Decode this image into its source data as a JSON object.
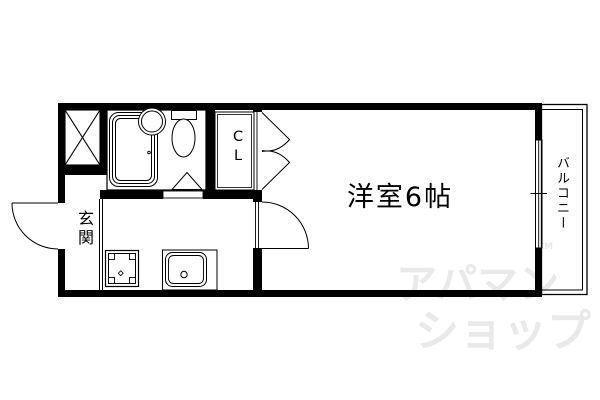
{
  "colors": {
    "line": "#000000",
    "background": "#ffffff",
    "watermark": "#e9e9e9"
  },
  "floor_plan": {
    "western_room": {
      "label": "洋室6帖"
    },
    "entrance": {
      "label": "玄関"
    },
    "balcony": {
      "label": "バルコニー"
    },
    "closet": {
      "letters": [
        "C",
        "L"
      ]
    },
    "fixture_icons": [
      "bathtub-icon",
      "wash-basin-icon",
      "toilet-icon",
      "kitchen-sink-icon",
      "stove-icon",
      "pipe-shaft-icon",
      "window-icon",
      "door-swing-icon",
      "folding-door-icon",
      "double-door-icon"
    ]
  },
  "watermark": {
    "line1": "アパマン",
    "tm": "TM",
    "line2": "ショップ"
  }
}
